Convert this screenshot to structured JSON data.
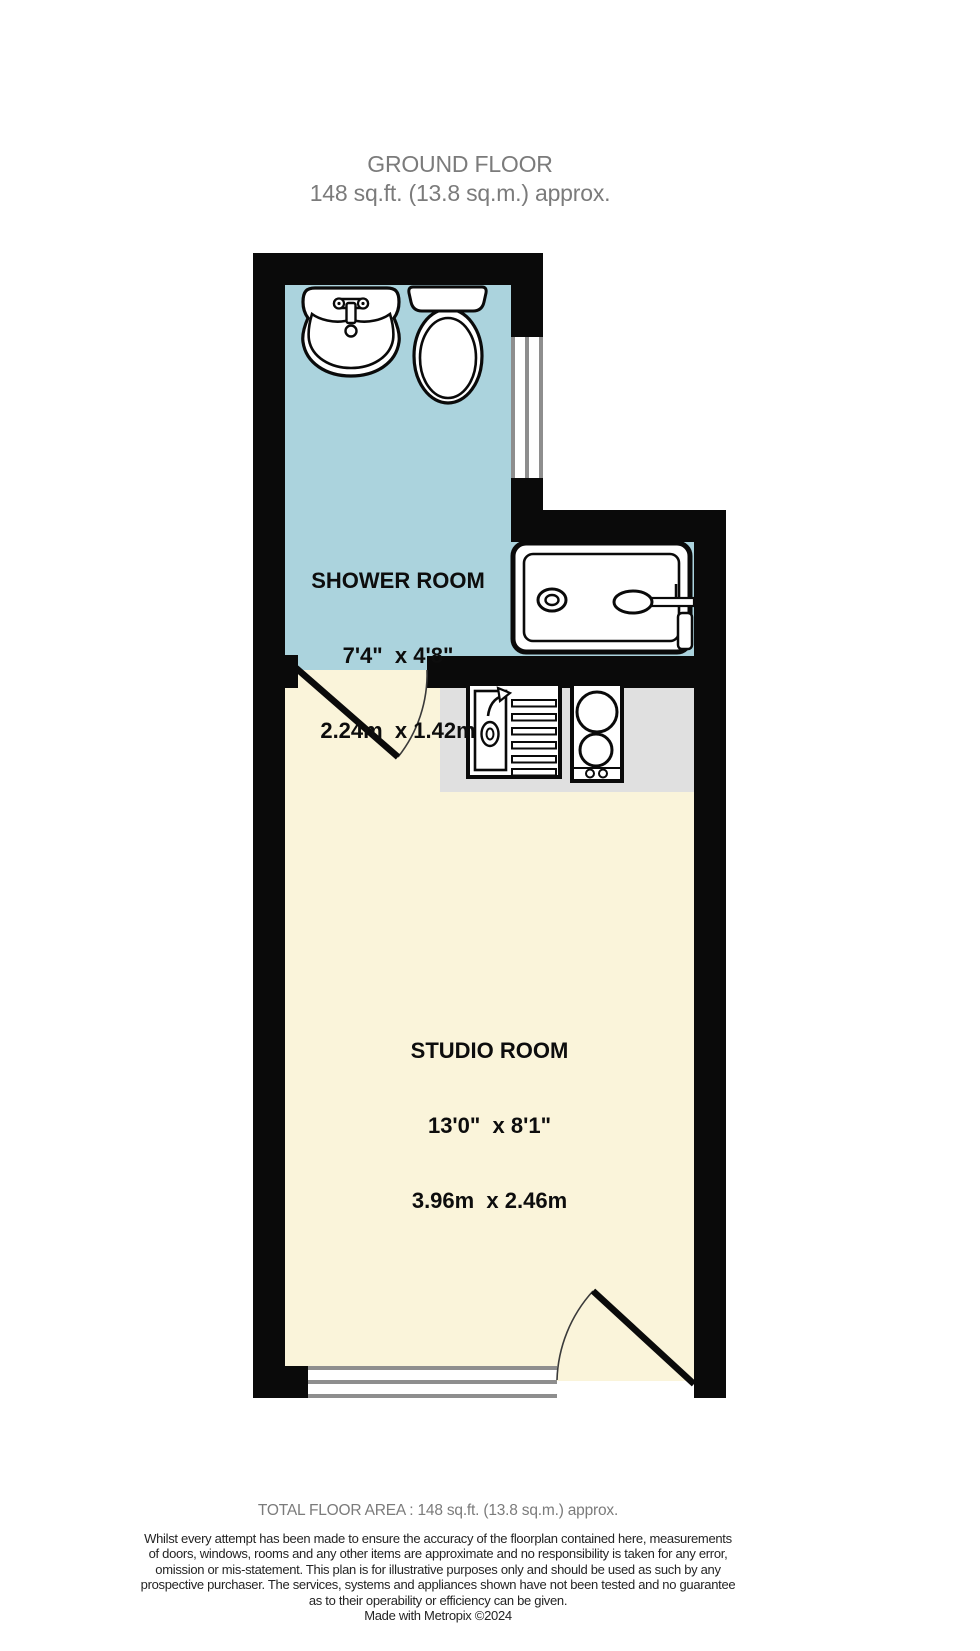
{
  "title": {
    "floor": "GROUND FLOOR",
    "area": "148 sq.ft. (13.8 sq.m.) approx."
  },
  "rooms": {
    "shower": {
      "name": "SHOWER ROOM",
      "imperial": "7'4\"  x 4'8\"",
      "metric": "2.24m  x 1.42m"
    },
    "studio": {
      "name": "STUDIO ROOM",
      "imperial": "13'0\"  x 8'1\"",
      "metric": "3.96m  x 2.46m"
    }
  },
  "fixtures": {
    "washbasin": "washbasin with taps",
    "toilet": "toilet",
    "shower": "shower tray with shower head",
    "kitchen_sink": "kitchen sink with drainer",
    "hob": "two-ring hob",
    "counter": "kitchen counter",
    "window_count": 2,
    "door_count": 2
  },
  "footer": {
    "total_area": "TOTAL FLOOR AREA : 148 sq.ft. (13.8 sq.m.) approx.",
    "disclaimer": "Whilst every attempt has been made to ensure the accuracy of the floorplan contained here, measurements\nof doors, windows, rooms and any other items are approximate and no responsibility is taken for any error,\nomission or mis-statement. This plan is for illustrative purposes only and should be used as such by any\nprospective purchaser. The services, systems and appliances shown have not been tested and no guarantee\nas to their operability or efficiency can be given.",
    "credit": "Made with Metropix ©2024"
  },
  "colors": {
    "wall": "#0a0a0a",
    "shower_room_floor": "#abd3dd",
    "studio_floor": "#faf4da",
    "counter": "#e0e0e0",
    "window_frame": "#8e8e8e",
    "muted_text": "#7b7b7b"
  }
}
